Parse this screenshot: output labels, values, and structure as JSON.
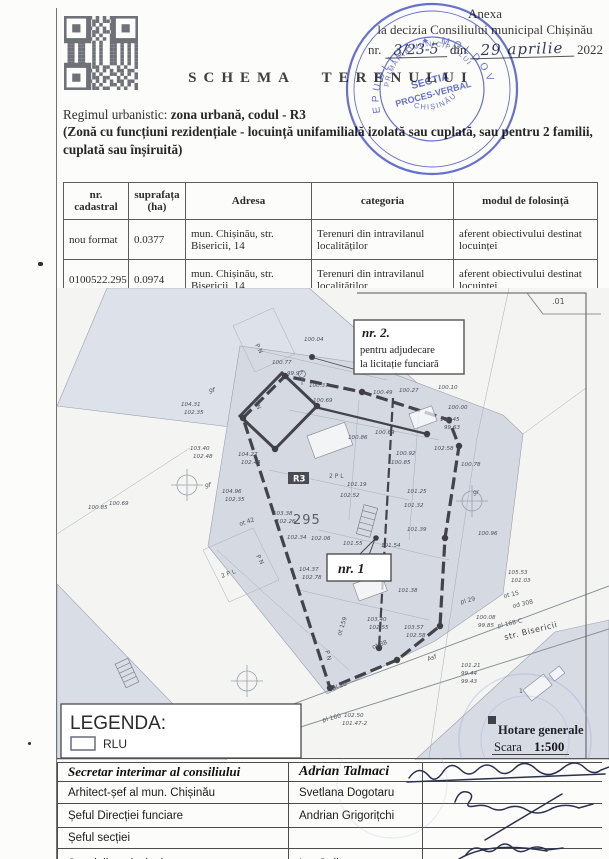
{
  "page": {
    "width": 609,
    "height": 859,
    "paper_color": "#fcfcfa",
    "stamp_color": "#4553c9",
    "map_gray": "#d5d9e2"
  },
  "annex": {
    "line1": "Anexa",
    "line2": "la decizia Consiliului municipal Chișinău",
    "nr_label": "nr.",
    "nr_value": "3/23-5",
    "din_label": "din",
    "date_value": "29 aprilie",
    "year": "2022"
  },
  "title": "SCHEMA TERENULUI",
  "stamp": {
    "arc_text": "REPUBLICA ✦ MOLDOVA",
    "ring_text_top": "PRIMĂRIA MUNICIPIULUI",
    "ring_text_bottom": "CHIȘINĂU",
    "center_line1": "SECTIA",
    "center_line2": "PROCES-VERBAL"
  },
  "urbanism": {
    "prefix": "Regimul urbanistic: ",
    "bold": "zona urbană, codul - R3",
    "paren_line1": "(Zonă cu funcțiuni rezidențiale - locuință unifamilială izolată sau cuplată, sau pentru 2 familii,",
    "paren_line2": "cuplată sau înșiruită)"
  },
  "parcel_table": {
    "headers": [
      "nr. cadastral",
      "suprafața (ha)",
      "Adresa",
      "categoria",
      "modul de folosință"
    ],
    "rows": [
      [
        "nou format",
        "0.0377",
        "mun. Chișinău, str. Bisericii, 14",
        "Terenuri din intravilanul localităților",
        "aferent obiectivului destinat locuinței"
      ],
      [
        "0100522.295",
        "0.0974",
        "mun. Chișinău, str. Bisericii, 14",
        "Terenuri din intravilanul localităților",
        "aferent obiectivului destinat locuinței"
      ]
    ]
  },
  "map": {
    "callout_nr2": {
      "title": "nr. 2.",
      "line1": "pentru adjudecare",
      "line2": "la licitație funciară"
    },
    "callout_nr1": {
      "title": "nr. 1"
    },
    "parcel_number": "295",
    "zone_code": "R3",
    "corner_label": ".01",
    "street_label": "str. Bisericii",
    "legend": {
      "title": "LEGENDA:",
      "item": "RLU"
    },
    "map_legend": {
      "hotare": "Hotare generale",
      "scara_label": "Scara",
      "scara_value": "1:500"
    },
    "labels": [
      {
        "t": "P N",
        "x": 198,
        "y": 57,
        "r": 62
      },
      {
        "t": "P N",
        "x": 196,
        "y": 113,
        "r": 62
      },
      {
        "t": "P N",
        "x": 199,
        "y": 268,
        "r": 62
      },
      {
        "t": "P N",
        "x": 268,
        "y": 363,
        "r": 75
      },
      {
        "t": "2 P L",
        "x": 272,
        "y": 190
      },
      {
        "t": "2 P L",
        "x": 165,
        "y": 290,
        "r": -20
      },
      {
        "t": "gf",
        "x": 152,
        "y": 104
      },
      {
        "t": "gf",
        "x": 148,
        "y": 199
      },
      {
        "t": "gr",
        "x": 416,
        "y": 206
      },
      {
        "t": "ot 42",
        "x": 183,
        "y": 238,
        "r": -18
      },
      {
        "t": "ot 159",
        "x": 284,
        "y": 348,
        "r": -72
      },
      {
        "t": "ot 88",
        "x": 316,
        "y": 361,
        "r": -20
      },
      {
        "t": "pl 20",
        "x": 276,
        "y": 402,
        "r": -18
      },
      {
        "t": "pl 29",
        "x": 404,
        "y": 316,
        "r": -14
      },
      {
        "t": "pl 160",
        "x": 266,
        "y": 434,
        "r": -14
      },
      {
        "t": "pl 168-C",
        "x": 441,
        "y": 340,
        "r": -13
      },
      {
        "t": "ot 15",
        "x": 447,
        "y": 310,
        "r": -13
      },
      {
        "t": "od 308",
        "x": 456,
        "y": 320,
        "r": -13
      },
      {
        "t": "Asf",
        "x": 371,
        "y": 373,
        "r": -18
      },
      {
        "t": "1",
        "x": 462,
        "y": 405
      }
    ],
    "elevations": [
      {
        "v": "100.04",
        "x": 247,
        "y": 53
      },
      {
        "v": "100.77",
        "x": 215,
        "y": 76
      },
      {
        "v": "99.97",
        "x": 230,
        "y": 87
      },
      {
        "v": "100.37",
        "x": 252,
        "y": 99
      },
      {
        "v": "100.69",
        "x": 256,
        "y": 114
      },
      {
        "v": "100.49",
        "x": 316,
        "y": 106
      },
      {
        "v": "100.27",
        "x": 342,
        "y": 104
      },
      {
        "v": "100.10",
        "x": 381,
        "y": 101
      },
      {
        "v": "100.00",
        "x": 391,
        "y": 121
      },
      {
        "v": "100.45",
        "x": 383,
        "y": 133
      },
      {
        "v": "99.63",
        "x": 387,
        "y": 141
      },
      {
        "v": "102.58",
        "x": 377,
        "y": 162
      },
      {
        "v": "100.78",
        "x": 404,
        "y": 178
      },
      {
        "v": "100.96",
        "x": 421,
        "y": 247
      },
      {
        "v": "104.31",
        "x": 124,
        "y": 118
      },
      {
        "v": "102.35",
        "x": 127,
        "y": 126
      },
      {
        "v": "103.40",
        "x": 133,
        "y": 162
      },
      {
        "v": "102.48",
        "x": 136,
        "y": 170
      },
      {
        "v": "104.27",
        "x": 181,
        "y": 168
      },
      {
        "v": "102.44",
        "x": 184,
        "y": 176
      },
      {
        "v": "104.96",
        "x": 165,
        "y": 205
      },
      {
        "v": "102.35",
        "x": 168,
        "y": 213
      },
      {
        "v": "103.38",
        "x": 216,
        "y": 227
      },
      {
        "v": "102.26",
        "x": 219,
        "y": 235
      },
      {
        "v": "102.34",
        "x": 230,
        "y": 251
      },
      {
        "v": "100.85",
        "x": 31,
        "y": 221
      },
      {
        "v": "100.69",
        "x": 52,
        "y": 217
      },
      {
        "v": "100.92",
        "x": 339,
        "y": 167
      },
      {
        "v": "100.85",
        "x": 334,
        "y": 176
      },
      {
        "v": "100.69",
        "x": 318,
        "y": 146
      },
      {
        "v": "100.86",
        "x": 291,
        "y": 151
      },
      {
        "v": "101.19",
        "x": 290,
        "y": 198
      },
      {
        "v": "102.52",
        "x": 283,
        "y": 209
      },
      {
        "v": "101.25",
        "x": 350,
        "y": 205
      },
      {
        "v": "101.32",
        "x": 347,
        "y": 219
      },
      {
        "v": "101.39",
        "x": 350,
        "y": 243
      },
      {
        "v": "102.06",
        "x": 254,
        "y": 252
      },
      {
        "v": "101.55",
        "x": 286,
        "y": 257
      },
      {
        "v": "101.54",
        "x": 324,
        "y": 259
      },
      {
        "v": "104.37",
        "x": 242,
        "y": 283
      },
      {
        "v": "102.78",
        "x": 245,
        "y": 291
      },
      {
        "v": "101.38",
        "x": 341,
        "y": 304
      },
      {
        "v": "105.53",
        "x": 451,
        "y": 286
      },
      {
        "v": "101.03",
        "x": 454,
        "y": 294
      },
      {
        "v": "100.08",
        "x": 419,
        "y": 331
      },
      {
        "v": "99.85",
        "x": 421,
        "y": 339
      },
      {
        "v": "101.21",
        "x": 404,
        "y": 379
      },
      {
        "v": "99.44",
        "x": 404,
        "y": 387
      },
      {
        "v": "99.43",
        "x": 404,
        "y": 395
      },
      {
        "v": "103.40",
        "x": 310,
        "y": 333
      },
      {
        "v": "102.55",
        "x": 312,
        "y": 341
      },
      {
        "v": "103.57",
        "x": 347,
        "y": 341
      },
      {
        "v": "102.58",
        "x": 349,
        "y": 349
      },
      {
        "v": "102.50",
        "x": 287,
        "y": 429
      },
      {
        "v": "101.47-2",
        "x": 285,
        "y": 437
      }
    ]
  },
  "signature_table": {
    "rows": [
      {
        "role": "Secretar interimar al consiliului",
        "name": "Adrian Talmaci"
      },
      {
        "role": "Arhitect-șef al mun. Chișinău",
        "name": "Svetlana Dogotaru"
      },
      {
        "role": "Șeful Direcției funciare",
        "name": "Andrian Grigorițchi"
      },
      {
        "role": "Șeful secției",
        "name": ""
      },
      {
        "role": "Specialist principal",
        "name": "Ion Galben"
      }
    ]
  }
}
